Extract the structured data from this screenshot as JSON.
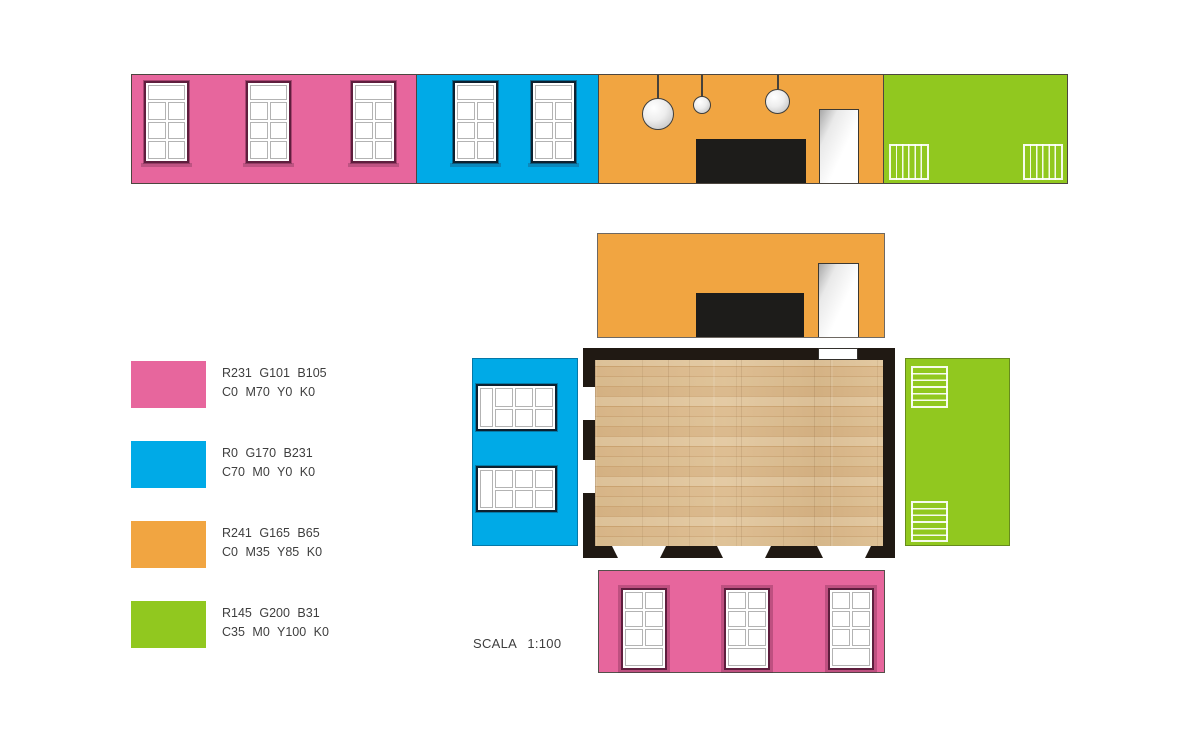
{
  "scale_label": "SCALA 1:100",
  "palette": {
    "pink": "#e7669d",
    "blue": "#00aae7",
    "orange": "#f1a541",
    "green": "#91c81f",
    "plan_wall": "#201913",
    "wood_floor": "#d8b488",
    "window_frame_pink_wall": "#5f1e3e",
    "window_frame_blue_wall": "#0d2130",
    "black_panel": "#1d1c1a"
  },
  "legend": {
    "items": [
      {
        "name": "pink",
        "color": "#e7669d",
        "rgb": "R231 G101 B105",
        "cmyk": "C0 M70 Y0 K0"
      },
      {
        "name": "blue",
        "color": "#00aae7",
        "rgb": "R0 G170 B231",
        "cmyk": "C70 M0 Y0 K0"
      },
      {
        "name": "orange",
        "color": "#f1a541",
        "rgb": "R241 G165 B65",
        "cmyk": "C0 M35 Y85 K0"
      },
      {
        "name": "green",
        "color": "#91c81f",
        "rgb": "R145 G200 B31",
        "cmyk": "C35 M0 Y100 K0"
      }
    ]
  }
}
